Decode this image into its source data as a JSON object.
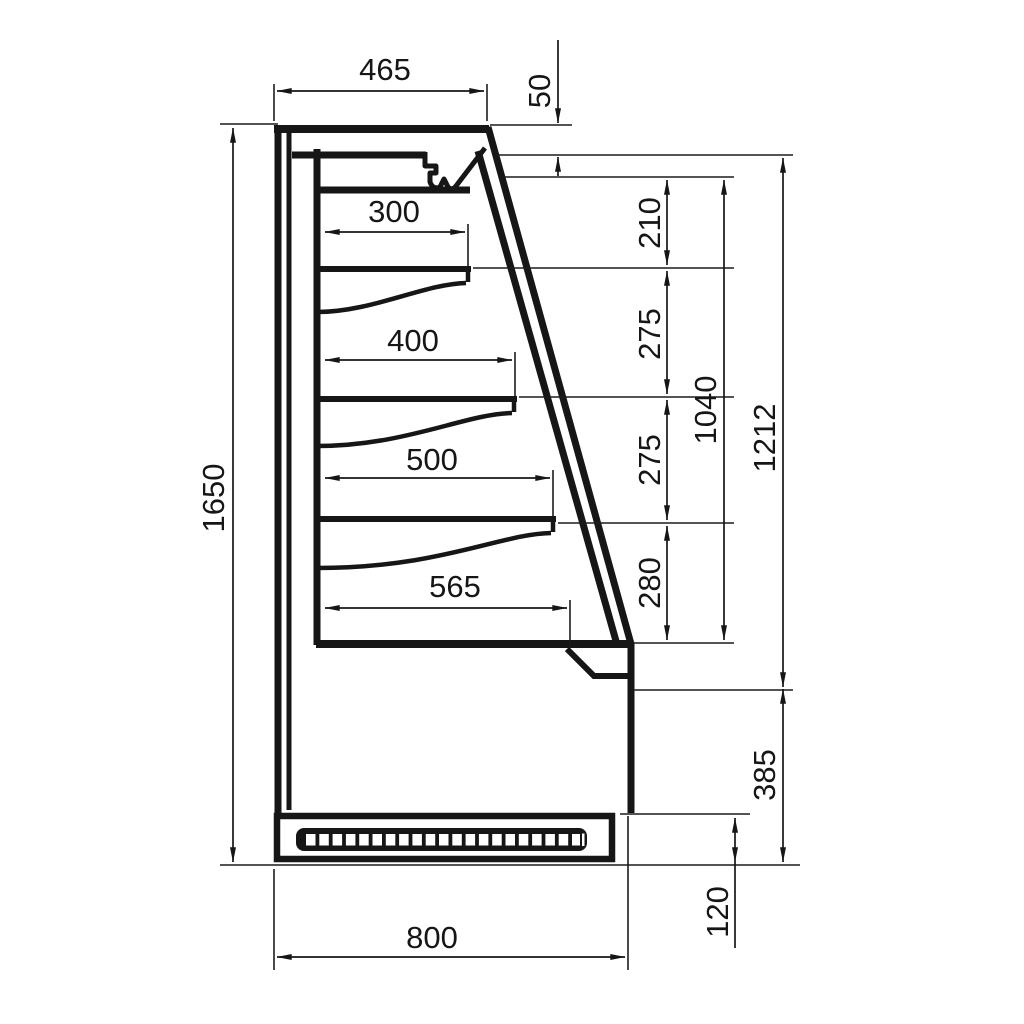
{
  "colors": {
    "ink": "#161616",
    "paper": "#ffffff"
  },
  "diagram": {
    "kind": "technical dimension drawing - refrigerated wall display case, side cross-section",
    "units": "mm",
    "labels": {
      "top_depth": "465",
      "canopy_drop": "50",
      "shelf1_depth": "300",
      "shelf2_depth": "400",
      "shelf3_depth": "500",
      "bottom_deck_depth": "565",
      "overall_height": "1650",
      "spacing_top": "210",
      "spacing_mid_upper": "275",
      "spacing_mid_lower": "275",
      "spacing_bottom": "280",
      "display_opening_height": "1040",
      "glass_front_height": "1212",
      "lower_body_height": "385",
      "plinth_height": "120",
      "overall_depth": "800"
    }
  }
}
